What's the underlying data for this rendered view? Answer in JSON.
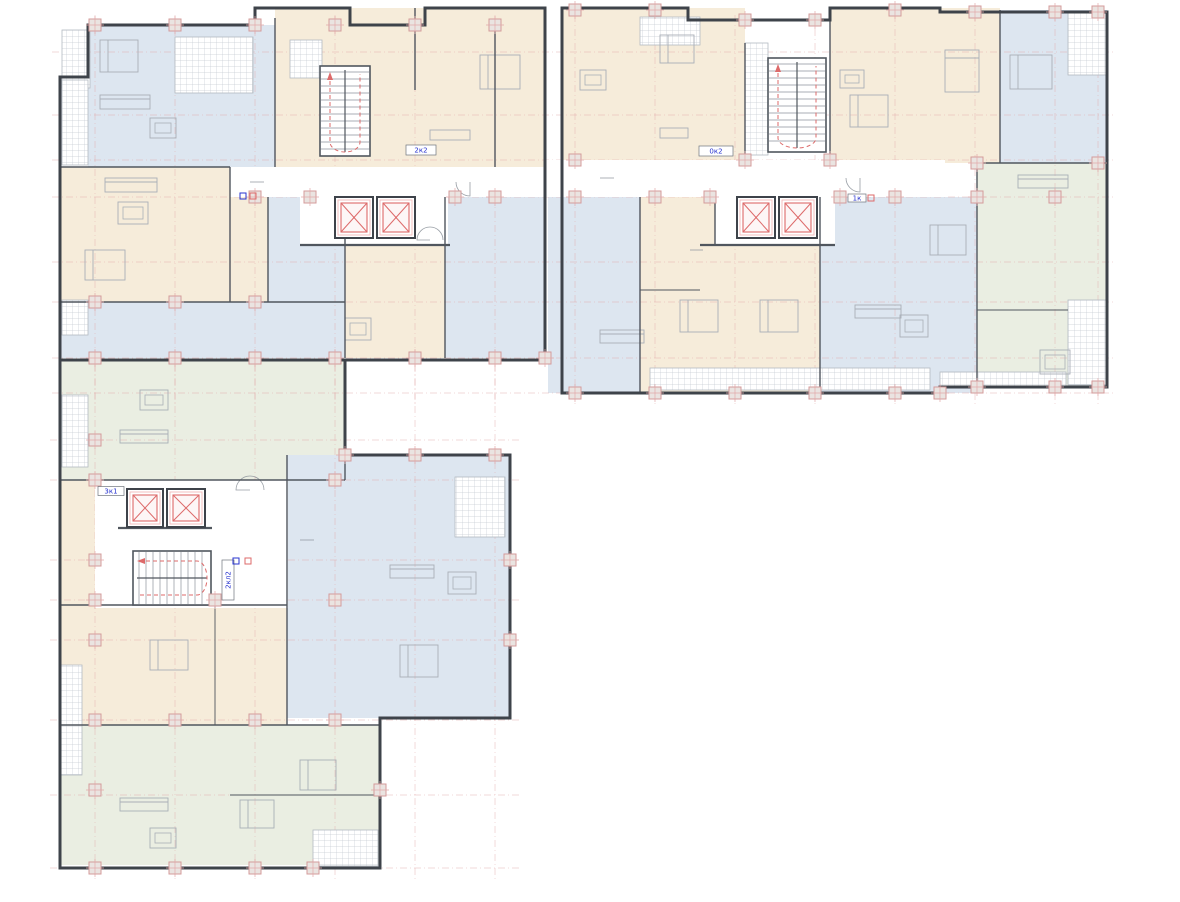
{
  "palette": {
    "blue": "#dde6f0",
    "cream": "#f6ecda",
    "green": "#eaeee2",
    "white": "#ffffff",
    "outline": "#3e434a",
    "wall": "#50565e",
    "thin": "#8d939b",
    "furn": "#a9afb7",
    "hatch": "#c6ccd3",
    "hatchEdge": "#b3bac1",
    "axis": "#e2a9a9",
    "axisGray": "#d9dce0",
    "red": "#dd6a6a",
    "redLight": "#f2b9b9",
    "labelBlue": "#2733cf",
    "colFill": "#eae4e1",
    "colStroke": "#d49b9b"
  },
  "plan": {
    "regions": [
      {
        "name": "apt-top-left",
        "color": "blue",
        "x": 88,
        "y": 25,
        "w": 187,
        "h": 142
      },
      {
        "name": "apt-top-left-2",
        "color": "cream",
        "x": 275,
        "y": 8,
        "w": 270,
        "h": 159
      },
      {
        "name": "apt-left-living",
        "color": "cream",
        "x": 60,
        "y": 167,
        "w": 210,
        "h": 135
      },
      {
        "name": "apt-left-mid",
        "color": "blue",
        "x": 268,
        "y": 197,
        "w": 77,
        "h": 105
      },
      {
        "name": "apt-left-bottom",
        "color": "blue",
        "x": 60,
        "y": 302,
        "w": 285,
        "h": 56
      },
      {
        "name": "apt-left-core-side",
        "color": "cream",
        "x": 345,
        "y": 245,
        "w": 100,
        "h": 113
      },
      {
        "name": "apt-left-right",
        "color": "blue",
        "x": 445,
        "y": 197,
        "w": 100,
        "h": 161
      },
      {
        "name": "apt-mid-top-left",
        "color": "cream",
        "x": 562,
        "y": 8,
        "w": 183,
        "h": 152
      },
      {
        "name": "apt-mid-top-right",
        "color": "cream",
        "x": 830,
        "y": 8,
        "w": 170,
        "h": 155
      },
      {
        "name": "apt-mid-bath",
        "color": "cream",
        "x": 640,
        "y": 197,
        "w": 75,
        "h": 48
      },
      {
        "name": "apt-mid-bottom-left",
        "color": "blue",
        "x": 548,
        "y": 197,
        "w": 92,
        "h": 196
      },
      {
        "name": "apt-mid-bottom-center",
        "color": "cream",
        "x": 640,
        "y": 245,
        "w": 180,
        "h": 148
      },
      {
        "name": "apt-mid-bottom-right",
        "color": "blue",
        "x": 820,
        "y": 197,
        "w": 157,
        "h": 196
      },
      {
        "name": "apt-right-top",
        "color": "blue",
        "x": 1000,
        "y": 10,
        "w": 107,
        "h": 153
      },
      {
        "name": "apt-right-green",
        "color": "green",
        "x": 977,
        "y": 163,
        "w": 130,
        "h": 224
      },
      {
        "name": "apt-wing-green-top",
        "color": "green",
        "x": 60,
        "y": 360,
        "w": 285,
        "h": 120
      },
      {
        "name": "apt-wing-blue",
        "color": "blue",
        "x": 287,
        "y": 455,
        "w": 223,
        "h": 263
      },
      {
        "name": "apt-wing-left-strip",
        "color": "cream",
        "x": 60,
        "y": 480,
        "w": 35,
        "h": 125
      },
      {
        "name": "apt-wing-cream",
        "color": "cream",
        "x": 60,
        "y": 605,
        "w": 227,
        "h": 120
      },
      {
        "name": "apt-wing-green-bottom",
        "color": "green",
        "x": 60,
        "y": 725,
        "w": 320,
        "h": 140
      }
    ],
    "corridors": [
      {
        "x": 230,
        "y": 167,
        "w": 315,
        "h": 30
      },
      {
        "x": 545,
        "y": 160,
        "w": 400,
        "h": 37
      },
      {
        "x": 300,
        "y": 197,
        "w": 148,
        "h": 48
      },
      {
        "x": 715,
        "y": 195,
        "w": 120,
        "h": 50
      },
      {
        "x": 95,
        "y": 480,
        "w": 193,
        "h": 128
      }
    ],
    "hatches": [
      {
        "x": 62,
        "y": 30,
        "w": 28,
        "h": 58
      },
      {
        "x": 175,
        "y": 37,
        "w": 78,
        "h": 56
      },
      {
        "x": 290,
        "y": 40,
        "w": 32,
        "h": 38
      },
      {
        "x": 62,
        "y": 80,
        "w": 26,
        "h": 85
      },
      {
        "x": 62,
        "y": 300,
        "w": 26,
        "h": 35
      },
      {
        "x": 640,
        "y": 17,
        "w": 60,
        "h": 28
      },
      {
        "x": 745,
        "y": 43,
        "w": 23,
        "h": 112
      },
      {
        "x": 1068,
        "y": 12,
        "w": 39,
        "h": 63
      },
      {
        "x": 650,
        "y": 368,
        "w": 280,
        "h": 22
      },
      {
        "x": 1068,
        "y": 300,
        "w": 39,
        "h": 85
      },
      {
        "x": 940,
        "y": 372,
        "w": 126,
        "h": 14
      },
      {
        "x": 455,
        "y": 477,
        "w": 50,
        "h": 60
      },
      {
        "x": 62,
        "y": 395,
        "w": 26,
        "h": 72
      },
      {
        "x": 60,
        "y": 665,
        "w": 22,
        "h": 110
      },
      {
        "x": 313,
        "y": 830,
        "w": 65,
        "h": 36
      }
    ],
    "outlines": [
      {
        "name": "block-left",
        "points": "60,77 88,77 88,25 255,25 255,8 350,8 350,25 425,25 425,8 545,8 545,360 60,360"
      },
      {
        "name": "block-middle-right",
        "points": "562,8 688,8 688,20 830,20 830,8 940,8 940,12 1107,12 1107,387 940,387 940,393 562,393"
      },
      {
        "name": "block-wing",
        "points": "60,360 345,360 345,455 510,455 510,718 380,718 380,868 60,868"
      }
    ],
    "walls": [
      {
        "x1": 275,
        "y1": 18,
        "x2": 275,
        "y2": 167
      },
      {
        "x1": 230,
        "y1": 167,
        "x2": 230,
        "y2": 302
      },
      {
        "x1": 268,
        "y1": 197,
        "x2": 268,
        "y2": 302
      },
      {
        "x1": 345,
        "y1": 197,
        "x2": 345,
        "y2": 358
      },
      {
        "x1": 445,
        "y1": 197,
        "x2": 445,
        "y2": 358
      },
      {
        "x1": 60,
        "y1": 302,
        "x2": 345,
        "y2": 302
      },
      {
        "x1": 60,
        "y1": 167,
        "x2": 230,
        "y2": 167
      },
      {
        "x1": 415,
        "y1": 8,
        "x2": 415,
        "y2": 90
      },
      {
        "x1": 495,
        "y1": 25,
        "x2": 495,
        "y2": 167
      },
      {
        "x1": 300,
        "y1": 245,
        "x2": 450,
        "y2": 245,
        "w": 2.2
      },
      {
        "x1": 640,
        "y1": 197,
        "x2": 640,
        "y2": 393
      },
      {
        "x1": 715,
        "y1": 197,
        "x2": 715,
        "y2": 245
      },
      {
        "x1": 820,
        "y1": 197,
        "x2": 820,
        "y2": 393
      },
      {
        "x1": 745,
        "y1": 43,
        "x2": 745,
        "y2": 160
      },
      {
        "x1": 830,
        "y1": 20,
        "x2": 830,
        "y2": 160
      },
      {
        "x1": 700,
        "y1": 245,
        "x2": 835,
        "y2": 245,
        "w": 2.2
      },
      {
        "x1": 640,
        "y1": 290,
        "x2": 700,
        "y2": 290,
        "w": 0.9
      },
      {
        "x1": 1000,
        "y1": 10,
        "x2": 1000,
        "y2": 163
      },
      {
        "x1": 977,
        "y1": 163,
        "x2": 977,
        "y2": 387
      },
      {
        "x1": 977,
        "y1": 163,
        "x2": 1107,
        "y2": 163
      },
      {
        "x1": 977,
        "y1": 310,
        "x2": 1068,
        "y2": 310,
        "w": 0.9
      },
      {
        "x1": 60,
        "y1": 480,
        "x2": 345,
        "y2": 480
      },
      {
        "x1": 60,
        "y1": 605,
        "x2": 287,
        "y2": 605
      },
      {
        "x1": 60,
        "y1": 725,
        "x2": 380,
        "y2": 725
      },
      {
        "x1": 287,
        "y1": 455,
        "x2": 287,
        "y2": 725
      },
      {
        "x1": 215,
        "y1": 605,
        "x2": 215,
        "y2": 725,
        "w": 0.9
      },
      {
        "x1": 345,
        "y1": 455,
        "x2": 345,
        "y2": 480
      },
      {
        "x1": 380,
        "y1": 718,
        "x2": 380,
        "y2": 868
      },
      {
        "x1": 230,
        "y1": 795,
        "x2": 380,
        "y2": 795,
        "w": 0.9
      },
      {
        "x1": 118,
        "y1": 528,
        "x2": 212,
        "y2": 528,
        "w": 2.2
      },
      {
        "x1": 562,
        "y1": 160,
        "x2": 562,
        "y2": 393
      }
    ],
    "elevators": [
      {
        "x": 335,
        "y": 197,
        "w": 38,
        "h": 41
      },
      {
        "x": 377,
        "y": 197,
        "w": 38,
        "h": 41
      },
      {
        "x": 737,
        "y": 197,
        "w": 38,
        "h": 41
      },
      {
        "x": 779,
        "y": 197,
        "w": 38,
        "h": 41
      },
      {
        "x": 127,
        "y": 489,
        "w": 36,
        "h": 38
      },
      {
        "x": 167,
        "y": 489,
        "w": 38,
        "h": 38
      }
    ],
    "stairs": [
      {
        "x": 320,
        "y": 66,
        "w": 50,
        "h": 90,
        "dir": "v"
      },
      {
        "x": 768,
        "y": 58,
        "w": 58,
        "h": 94,
        "dir": "v"
      },
      {
        "x": 133,
        "y": 551,
        "w": 78,
        "h": 54,
        "dir": "h"
      }
    ],
    "grid": {
      "vTop": [
        95,
        175,
        255,
        335,
        415,
        495,
        575,
        655,
        735,
        815,
        895,
        975,
        1055,
        1098
      ],
      "vWing": [
        95,
        175,
        255,
        335,
        415,
        495
      ],
      "hTop": [
        52,
        115,
        160,
        197,
        262,
        302,
        358,
        393
      ],
      "hWing": [
        440,
        480,
        560,
        600,
        640,
        720,
        795,
        868
      ]
    },
    "columns": [
      [
        95,
        25
      ],
      [
        175,
        25
      ],
      [
        255,
        25
      ],
      [
        335,
        25
      ],
      [
        415,
        25
      ],
      [
        495,
        25
      ],
      [
        575,
        10
      ],
      [
        655,
        10
      ],
      [
        745,
        20
      ],
      [
        815,
        20
      ],
      [
        895,
        10
      ],
      [
        975,
        12
      ],
      [
        1055,
        12
      ],
      [
        1098,
        12
      ],
      [
        255,
        197
      ],
      [
        310,
        197
      ],
      [
        455,
        197
      ],
      [
        495,
        197
      ],
      [
        575,
        197
      ],
      [
        655,
        197
      ],
      [
        710,
        197
      ],
      [
        840,
        197
      ],
      [
        895,
        197
      ],
      [
        977,
        197
      ],
      [
        1055,
        197
      ],
      [
        575,
        160
      ],
      [
        745,
        160
      ],
      [
        830,
        160
      ],
      [
        977,
        163
      ],
      [
        1098,
        163
      ],
      [
        95,
        358
      ],
      [
        175,
        358
      ],
      [
        255,
        358
      ],
      [
        335,
        358
      ],
      [
        415,
        358
      ],
      [
        495,
        358
      ],
      [
        545,
        358
      ],
      [
        575,
        393
      ],
      [
        655,
        393
      ],
      [
        735,
        393
      ],
      [
        815,
        393
      ],
      [
        895,
        393
      ],
      [
        940,
        393
      ],
      [
        977,
        387
      ],
      [
        1055,
        387
      ],
      [
        1098,
        387
      ],
      [
        95,
        302
      ],
      [
        175,
        302
      ],
      [
        255,
        302
      ],
      [
        95,
        440
      ],
      [
        95,
        480
      ],
      [
        95,
        560
      ],
      [
        95,
        600
      ],
      [
        95,
        640
      ],
      [
        95,
        720
      ],
      [
        95,
        790
      ],
      [
        95,
        868
      ],
      [
        175,
        720
      ],
      [
        255,
        720
      ],
      [
        335,
        720
      ],
      [
        175,
        868
      ],
      [
        255,
        868
      ],
      [
        313,
        868
      ],
      [
        215,
        600
      ],
      [
        335,
        480
      ],
      [
        335,
        600
      ],
      [
        345,
        455
      ],
      [
        415,
        455
      ],
      [
        495,
        455
      ],
      [
        510,
        560
      ],
      [
        510,
        640
      ],
      [
        380,
        790
      ]
    ],
    "furniture": [
      {
        "t": "bed",
        "x": 100,
        "y": 40,
        "w": 38,
        "h": 32
      },
      {
        "t": "bed",
        "x": 480,
        "y": 55,
        "w": 40,
        "h": 34
      },
      {
        "t": "bed",
        "x": 660,
        "y": 35,
        "w": 34,
        "h": 28
      },
      {
        "t": "bed",
        "x": 850,
        "y": 95,
        "w": 38,
        "h": 32
      },
      {
        "t": "bed",
        "x": 945,
        "y": 50,
        "w": 34,
        "h": 42
      },
      {
        "t": "bed",
        "x": 1010,
        "y": 55,
        "w": 42,
        "h": 34
      },
      {
        "t": "bed",
        "x": 85,
        "y": 250,
        "w": 40,
        "h": 30
      },
      {
        "t": "bed",
        "x": 680,
        "y": 300,
        "w": 38,
        "h": 32
      },
      {
        "t": "bed",
        "x": 760,
        "y": 300,
        "w": 38,
        "h": 32
      },
      {
        "t": "bed",
        "x": 930,
        "y": 225,
        "w": 36,
        "h": 30
      },
      {
        "t": "bed",
        "x": 400,
        "y": 645,
        "w": 38,
        "h": 32
      },
      {
        "t": "bed",
        "x": 150,
        "y": 640,
        "w": 38,
        "h": 30
      },
      {
        "t": "bed",
        "x": 300,
        "y": 760,
        "w": 36,
        "h": 30
      },
      {
        "t": "bed",
        "x": 240,
        "y": 800,
        "w": 34,
        "h": 28
      },
      {
        "t": "sofa",
        "x": 105,
        "y": 178,
        "w": 52,
        "h": 14
      },
      {
        "t": "sofa",
        "x": 100,
        "y": 95,
        "w": 50,
        "h": 14
      },
      {
        "t": "sofa",
        "x": 600,
        "y": 330,
        "w": 44,
        "h": 13
      },
      {
        "t": "sofa",
        "x": 855,
        "y": 305,
        "w": 46,
        "h": 13
      },
      {
        "t": "sofa",
        "x": 1018,
        "y": 175,
        "w": 50,
        "h": 13
      },
      {
        "t": "sofa",
        "x": 120,
        "y": 430,
        "w": 48,
        "h": 13
      },
      {
        "t": "sofa",
        "x": 390,
        "y": 565,
        "w": 44,
        "h": 13
      },
      {
        "t": "sofa",
        "x": 120,
        "y": 798,
        "w": 48,
        "h": 13
      },
      {
        "t": "table",
        "x": 118,
        "y": 202,
        "w": 30,
        "h": 22
      },
      {
        "t": "table",
        "x": 150,
        "y": 118,
        "w": 26,
        "h": 20
      },
      {
        "t": "table",
        "x": 580,
        "y": 70,
        "w": 26,
        "h": 20
      },
      {
        "t": "table",
        "x": 1040,
        "y": 350,
        "w": 30,
        "h": 24
      },
      {
        "t": "table",
        "x": 900,
        "y": 315,
        "w": 28,
        "h": 22
      },
      {
        "t": "table",
        "x": 140,
        "y": 390,
        "w": 28,
        "h": 20
      },
      {
        "t": "table",
        "x": 448,
        "y": 572,
        "w": 28,
        "h": 22
      },
      {
        "t": "table",
        "x": 150,
        "y": 828,
        "w": 26,
        "h": 20
      },
      {
        "t": "table",
        "x": 345,
        "y": 318,
        "w": 26,
        "h": 22
      },
      {
        "t": "table",
        "x": 840,
        "y": 70,
        "w": 24,
        "h": 18
      },
      {
        "t": "counter",
        "x": 430,
        "y": 130,
        "w": 40,
        "h": 10
      },
      {
        "t": "counter",
        "x": 660,
        "y": 128,
        "w": 28,
        "h": 10
      }
    ],
    "doors": [
      {
        "x": 250,
        "y": 182,
        "r": 14,
        "a": 0
      },
      {
        "x": 470,
        "y": 182,
        "r": 14,
        "a": 90
      },
      {
        "x": 600,
        "y": 178,
        "r": 14,
        "a": 0
      },
      {
        "x": 860,
        "y": 178,
        "r": 14,
        "a": 90
      },
      {
        "x": 250,
        "y": 490,
        "r": 14,
        "a": 180
      },
      {
        "x": 300,
        "y": 540,
        "r": 14,
        "a": 0
      },
      {
        "x": 430,
        "y": 240,
        "r": 13,
        "a": 180
      },
      {
        "x": 690,
        "y": 250,
        "r": 13,
        "a": 0
      }
    ],
    "labels": [
      {
        "text": "2к2",
        "x": 421,
        "y": 150,
        "w": 30,
        "h": 10
      },
      {
        "text": "0к2",
        "x": 716,
        "y": 151,
        "w": 34,
        "h": 10
      },
      {
        "text": "1к",
        "x": 857,
        "y": 198,
        "w": 18,
        "h": 8
      },
      {
        "text": "3к1",
        "x": 111,
        "y": 491,
        "w": 26,
        "h": 9
      },
      {
        "text": "2кл2",
        "x": 228,
        "y": 580,
        "w": 12,
        "h": 40,
        "vertical": true
      }
    ],
    "marks": [
      {
        "x": 243,
        "y": 196,
        "c": "labelBlue"
      },
      {
        "x": 253,
        "y": 196,
        "c": "red"
      },
      {
        "x": 236,
        "y": 561,
        "c": "labelBlue"
      },
      {
        "x": 248,
        "y": 561,
        "c": "red"
      },
      {
        "x": 871,
        "y": 198,
        "c": "red"
      }
    ]
  }
}
